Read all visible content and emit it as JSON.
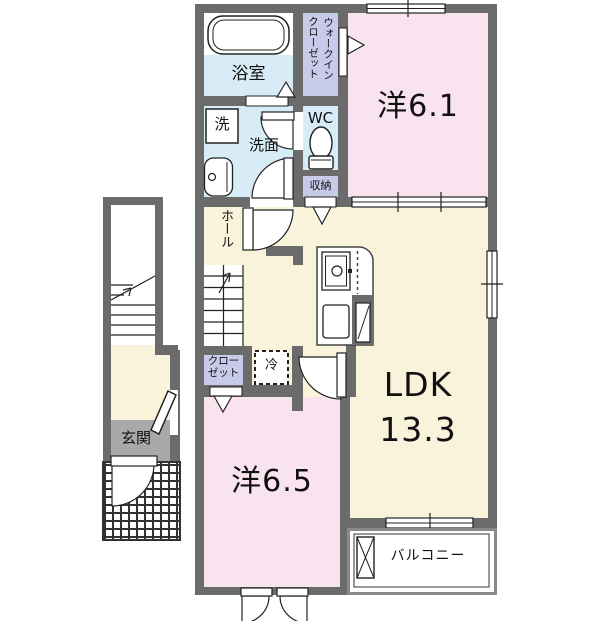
{
  "plan": {
    "type": "apartment-floor-plan",
    "rooms": {
      "bathroom": {
        "label": "浴室"
      },
      "washer": {
        "label": "洗"
      },
      "washroom": {
        "label": "洗面"
      },
      "walk_in_closet": {
        "line1": "ウォークイン",
        "line2": "クローゼット"
      },
      "wc": {
        "label": "WC"
      },
      "storage": {
        "label": "収納"
      },
      "hall": {
        "label": "ホール"
      },
      "closet": {
        "line1": "クロー",
        "line2": "ゼット"
      },
      "fridge": {
        "label": "冷"
      },
      "western_room_1": {
        "label": "洋6.1"
      },
      "ldk": {
        "line1": "LDK",
        "line2": "13.3"
      },
      "western_room_2": {
        "label": "洋6.5"
      },
      "entrance": {
        "label": "玄関"
      },
      "balcony": {
        "label": "バルコニー"
      }
    },
    "colors": {
      "wall": "#6b6b6b",
      "room_pink": "#f8e3ee",
      "room_cream": "#faf3dc",
      "room_blue": "#d8ecf7",
      "room_lavender": "#c7cae9",
      "entrance_gray": "#a9a9a9",
      "line": "#222222"
    }
  }
}
